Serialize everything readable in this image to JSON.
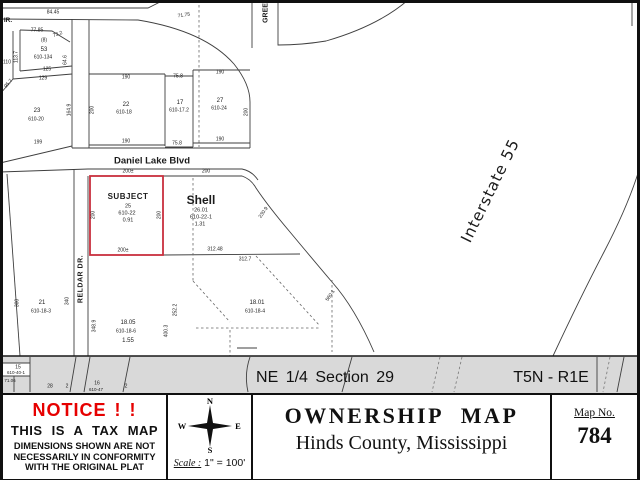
{
  "map": {
    "subject": {
      "title": "SUBJECT",
      "parcel": "25",
      "book": "610-22",
      "acres": "0.91"
    },
    "shell": {
      "name": "Shell",
      "parcel": "26.01",
      "book": "610-22-1",
      "acres": "1.31"
    },
    "streets": {
      "daniel_lake": "Daniel Lake Blvd",
      "reldar": "RELDAR DR.",
      "interstate": "Interstate 55",
      "green_partial": "GREE",
      "west_partial": "IR."
    },
    "labels": [
      {
        "t": "84.45",
        "x": 53,
        "y": 13,
        "s": 5
      },
      {
        "t": "71.75",
        "x": 184,
        "y": 16,
        "s": 5,
        "r": -8
      },
      {
        "t": "77.85",
        "x": 37,
        "y": 31,
        "s": 5
      },
      {
        "t": "73.2",
        "x": 58,
        "y": 35,
        "s": 5,
        "r": -20
      },
      {
        "t": "(8)",
        "x": 44,
        "y": 41,
        "s": 5
      },
      {
        "t": "53",
        "x": 44,
        "y": 50,
        "s": 6
      },
      {
        "t": "610-134",
        "x": 43,
        "y": 58,
        "s": 5
      },
      {
        "t": "113.7",
        "x": 17,
        "y": 57,
        "s": 5,
        "r": -90
      },
      {
        "t": "110",
        "x": 7,
        "y": 63,
        "s": 5
      },
      {
        "t": "64.6",
        "x": 66,
        "y": 60,
        "s": 5,
        "r": -90
      },
      {
        "t": "125",
        "x": 47,
        "y": 70,
        "s": 5
      },
      {
        "t": "129",
        "x": 43,
        "y": 79,
        "s": 5
      },
      {
        "t": "95.7",
        "x": 9,
        "y": 84,
        "s": 5,
        "r": -50
      },
      {
        "t": "23",
        "x": 37,
        "y": 111,
        "s": 6
      },
      {
        "t": "610-20",
        "x": 36,
        "y": 120,
        "s": 5
      },
      {
        "t": "164.9",
        "x": 70,
        "y": 110,
        "s": 5,
        "r": -90
      },
      {
        "t": "199",
        "x": 38,
        "y": 143,
        "s": 5
      },
      {
        "t": "190",
        "x": 126,
        "y": 78,
        "s": 5
      },
      {
        "t": "22",
        "x": 126,
        "y": 105,
        "s": 6
      },
      {
        "t": "610-18",
        "x": 124,
        "y": 113,
        "s": 5
      },
      {
        "t": "200",
        "x": 93,
        "y": 110,
        "s": 5,
        "r": -90
      },
      {
        "t": "190",
        "x": 126,
        "y": 142,
        "s": 5
      },
      {
        "t": "75.8",
        "x": 178,
        "y": 77,
        "s": 5
      },
      {
        "t": "17",
        "x": 180,
        "y": 103,
        "s": 6
      },
      {
        "t": "610-17.2",
        "x": 179,
        "y": 111,
        "s": 5
      },
      {
        "t": "75.8",
        "x": 177,
        "y": 144,
        "s": 5
      },
      {
        "t": "190",
        "x": 220,
        "y": 73,
        "s": 5
      },
      {
        "t": "27",
        "x": 220,
        "y": 101,
        "s": 6
      },
      {
        "t": "610-24",
        "x": 219,
        "y": 109,
        "s": 5
      },
      {
        "t": "190",
        "x": 220,
        "y": 140,
        "s": 5
      },
      {
        "t": "200",
        "x": 247,
        "y": 112,
        "s": 5,
        "r": -90
      },
      {
        "t": "200±",
        "x": 128,
        "y": 172,
        "s": 5
      },
      {
        "t": "200",
        "x": 94,
        "y": 215,
        "s": 5,
        "r": -90
      },
      {
        "t": "200",
        "x": 160,
        "y": 215,
        "s": 5,
        "r": -90
      },
      {
        "t": "200±",
        "x": 123,
        "y": 251,
        "s": 5
      },
      {
        "t": "200",
        "x": 206,
        "y": 172,
        "s": 5
      },
      {
        "t": "312.48",
        "x": 215,
        "y": 250,
        "s": 5
      },
      {
        "t": "312.7",
        "x": 245,
        "y": 260,
        "s": 5
      },
      {
        "t": "230.9",
        "x": 264,
        "y": 213,
        "s": 5,
        "r": -55
      },
      {
        "t": "560.1",
        "x": 331,
        "y": 296,
        "s": 5,
        "r": -55
      },
      {
        "t": "21",
        "x": 42,
        "y": 303,
        "s": 6
      },
      {
        "t": "610-18-3",
        "x": 41,
        "y": 312,
        "s": 5
      },
      {
        "t": "300",
        "x": 18,
        "y": 303,
        "s": 5,
        "r": -90
      },
      {
        "t": "340",
        "x": 68,
        "y": 301,
        "s": 5,
        "r": -90
      },
      {
        "t": "348.9",
        "x": 95,
        "y": 326,
        "s": 5,
        "r": -90
      },
      {
        "t": "18.05",
        "x": 128,
        "y": 323,
        "s": 6
      },
      {
        "t": "610-18-6",
        "x": 126,
        "y": 332,
        "s": 5
      },
      {
        "t": "1.55",
        "x": 128,
        "y": 341,
        "s": 6
      },
      {
        "t": "252.2",
        "x": 176,
        "y": 310,
        "s": 5,
        "r": -90
      },
      {
        "t": "400.3",
        "x": 167,
        "y": 331,
        "s": 5,
        "r": -90
      },
      {
        "t": "18.01",
        "x": 257,
        "y": 303,
        "s": 6
      },
      {
        "t": "610-18-4",
        "x": 255,
        "y": 312,
        "s": 5
      },
      {
        "t": "15",
        "x": 18,
        "y": 368,
        "s": 5
      },
      {
        "t": "610-40-1",
        "x": 16,
        "y": 373,
        "s": 4.5
      },
      {
        "t": "71.06",
        "x": 10,
        "y": 381,
        "s": 4.5
      },
      {
        "t": "28",
        "x": 50,
        "y": 387,
        "s": 5
      },
      {
        "t": "2",
        "x": 67,
        "y": 387,
        "s": 5
      },
      {
        "t": "16",
        "x": 97,
        "y": 384,
        "s": 5
      },
      {
        "t": "610-47",
        "x": 96,
        "y": 390,
        "s": 4.5
      },
      {
        "t": "2",
        "x": 126,
        "y": 387,
        "s": 5
      }
    ]
  },
  "band": {
    "section": "NE 1/4  Section 29",
    "township": "T5N - R1E"
  },
  "title_block": {
    "notice": {
      "heading": "NOTICE ! !",
      "line1": "THIS IS A TAX MAP",
      "line2": "DIMENSIONS SHOWN ARE NOT",
      "line3": "NECESSARILY IN CONFORMITY",
      "line4": "WITH THE ORIGINAL PLAT"
    },
    "compass": {
      "north": "N",
      "east": "E",
      "south": "S",
      "west": "W"
    },
    "scale": {
      "label": "Scale :",
      "value": "1\" = 100'"
    },
    "title": "OWNERSHIP MAP",
    "subtitle": "Hinds County, Mississippi",
    "map_no": {
      "label": "Map No.",
      "value": "784"
    }
  },
  "colors": {
    "subject_outline": "#c9303e",
    "notice_red": "#e60000",
    "band_bg": "#d9d9d9",
    "map_line": "#3f3f3f"
  }
}
